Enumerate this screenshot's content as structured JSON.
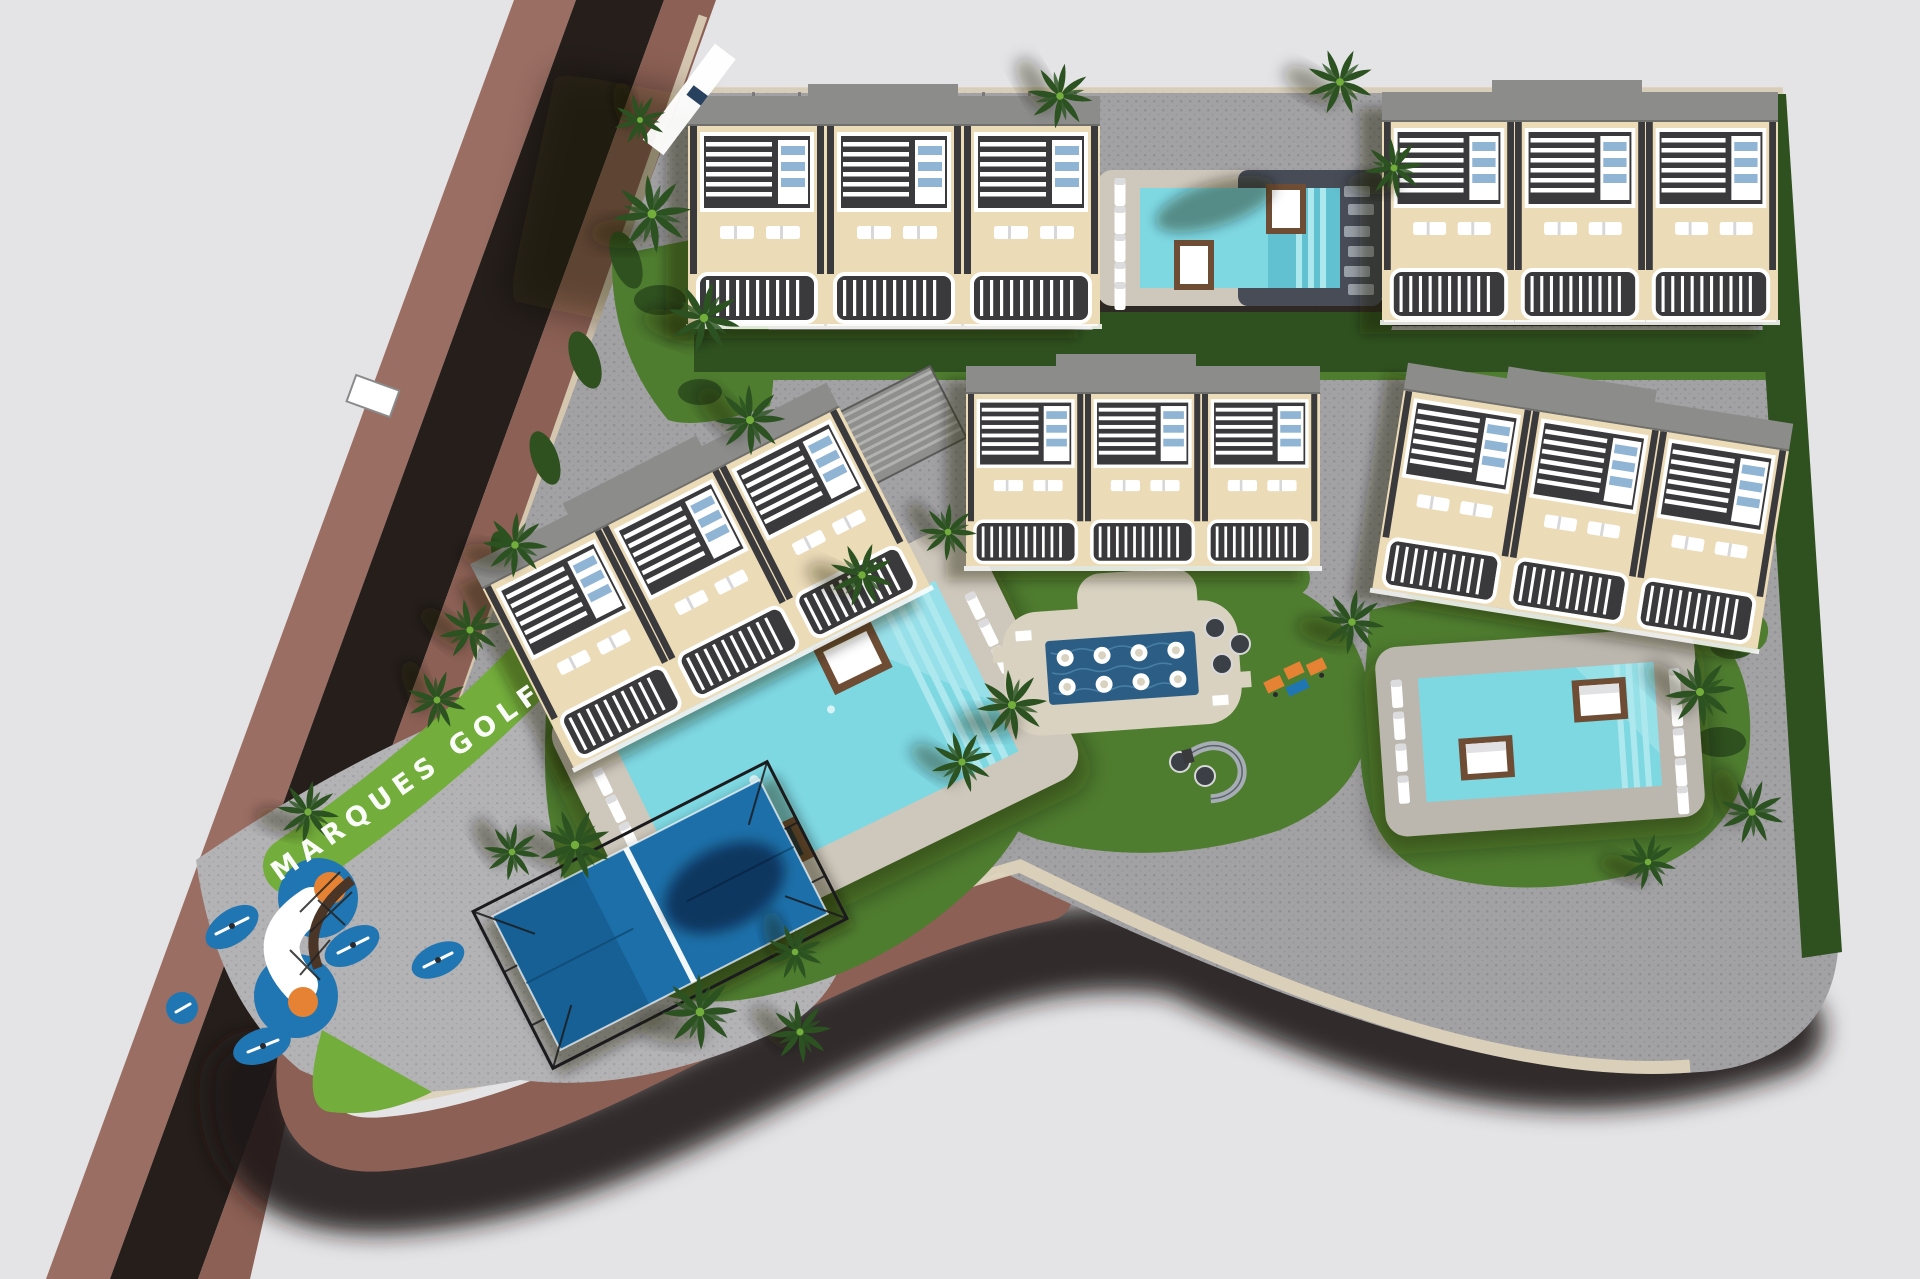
{
  "scene": {
    "site_label": "MARQUES GOLF",
    "colors": {
      "bg": "#e4e4e6",
      "sidewalk": "#9b6e63",
      "asphalt": "#251e1a",
      "road_band": "#8c6054",
      "curb": "#ddd2ba",
      "paving": "#a2a1a3",
      "paving_dot": "#8f8e91",
      "paving2": "#b3b2b4",
      "paving2_dot": "#a09fa2",
      "grass": "#4f7d2f",
      "lawn": "#73ad3b",
      "hedge": "#2f511f",
      "palm": "#2b5220",
      "building_body": "#ecdbb7",
      "building_roof": "#8c8c8a",
      "building_dark": "#3a393c",
      "white": "#ffffff",
      "glass": "#8fb4d4",
      "pool": "#7ed8e2",
      "pool_steps": "#ade8ee",
      "pool_dark": "#2c5e85",
      "deck_light": "#cec7bb",
      "deck_dark": "#474c56",
      "deck_tan": "#d9d2c1",
      "deck_gray": "#bcb7ae",
      "wood": "#6f4d35",
      "court": "#1c6fa9",
      "cage": "#1b1b1e",
      "play_blue": "#2076b3",
      "play_orange": "#e58233",
      "shadow": "rgba(25,20,16,0.40)"
    }
  }
}
